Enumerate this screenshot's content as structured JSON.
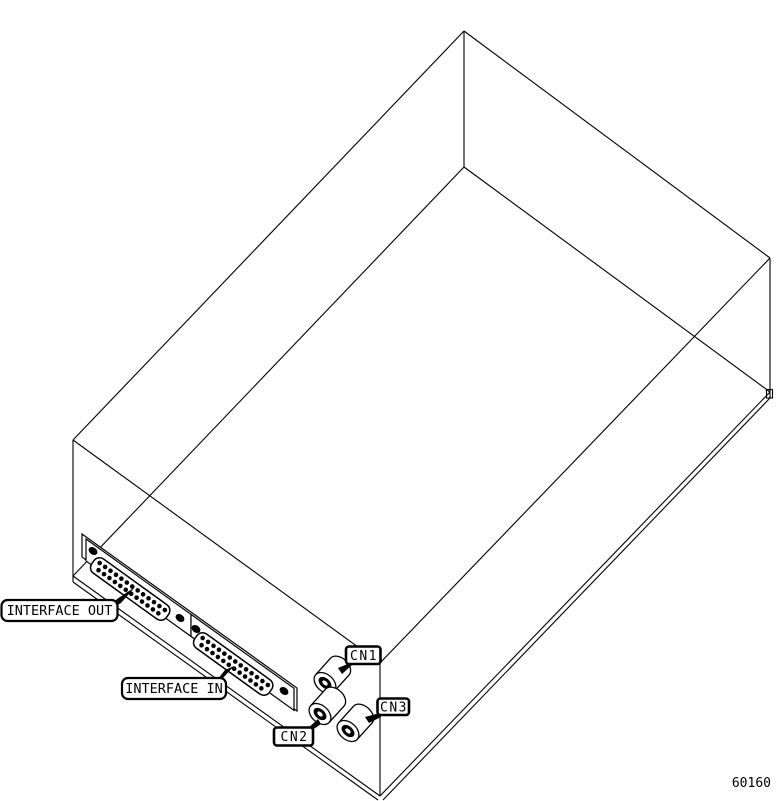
{
  "figure": {
    "drawing_number": "60160",
    "background_color": "#ffffff",
    "line_color": "#000000",
    "subject": "isometric wireframe drawing of equipment enclosure with connector panel"
  },
  "callouts": {
    "interface_out": "INTERFACE OUT",
    "interface_in": "INTERFACE IN",
    "cn1": "CN1",
    "cn2": "CN2",
    "cn3": "CN3"
  },
  "connector_pins": {
    "dsub_row1_count": 13,
    "dsub_row2_count": 12
  }
}
